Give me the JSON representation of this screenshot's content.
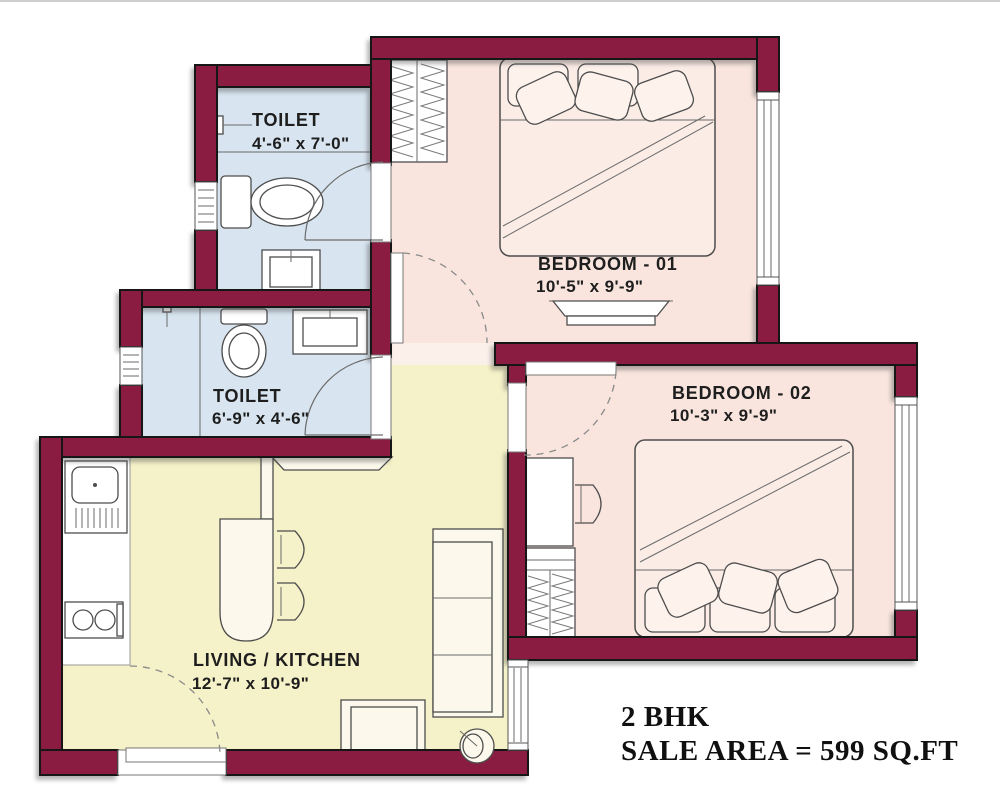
{
  "plan": {
    "rooms": [
      {
        "key": "toilet1",
        "name": "TOILET",
        "dims": "4'-6\" x 7'-0\""
      },
      {
        "key": "toilet2",
        "name": "TOILET",
        "dims": "6'-9\" x 4'-6\""
      },
      {
        "key": "bedroom1",
        "name": "BEDROOM - 01",
        "dims": "10'-5\" x 9'-9\""
      },
      {
        "key": "bedroom2",
        "name": "BEDROOM - 02",
        "dims": "10'-3\" x 9'-9\""
      },
      {
        "key": "living",
        "name": "LIVING / KITCHEN",
        "dims": "12'-7\" x 10'-9\""
      }
    ],
    "summary": {
      "unit_type": "2 BHK",
      "sale_area": "SALE AREA = 599 SQ.FT"
    },
    "colors": {
      "wall": "#8a1c42",
      "toilet_floor": "#d8e5f0",
      "bedroom_floor": "#f9e5de",
      "living_floor": "#f5f1c8",
      "outline": "#161616"
    }
  }
}
